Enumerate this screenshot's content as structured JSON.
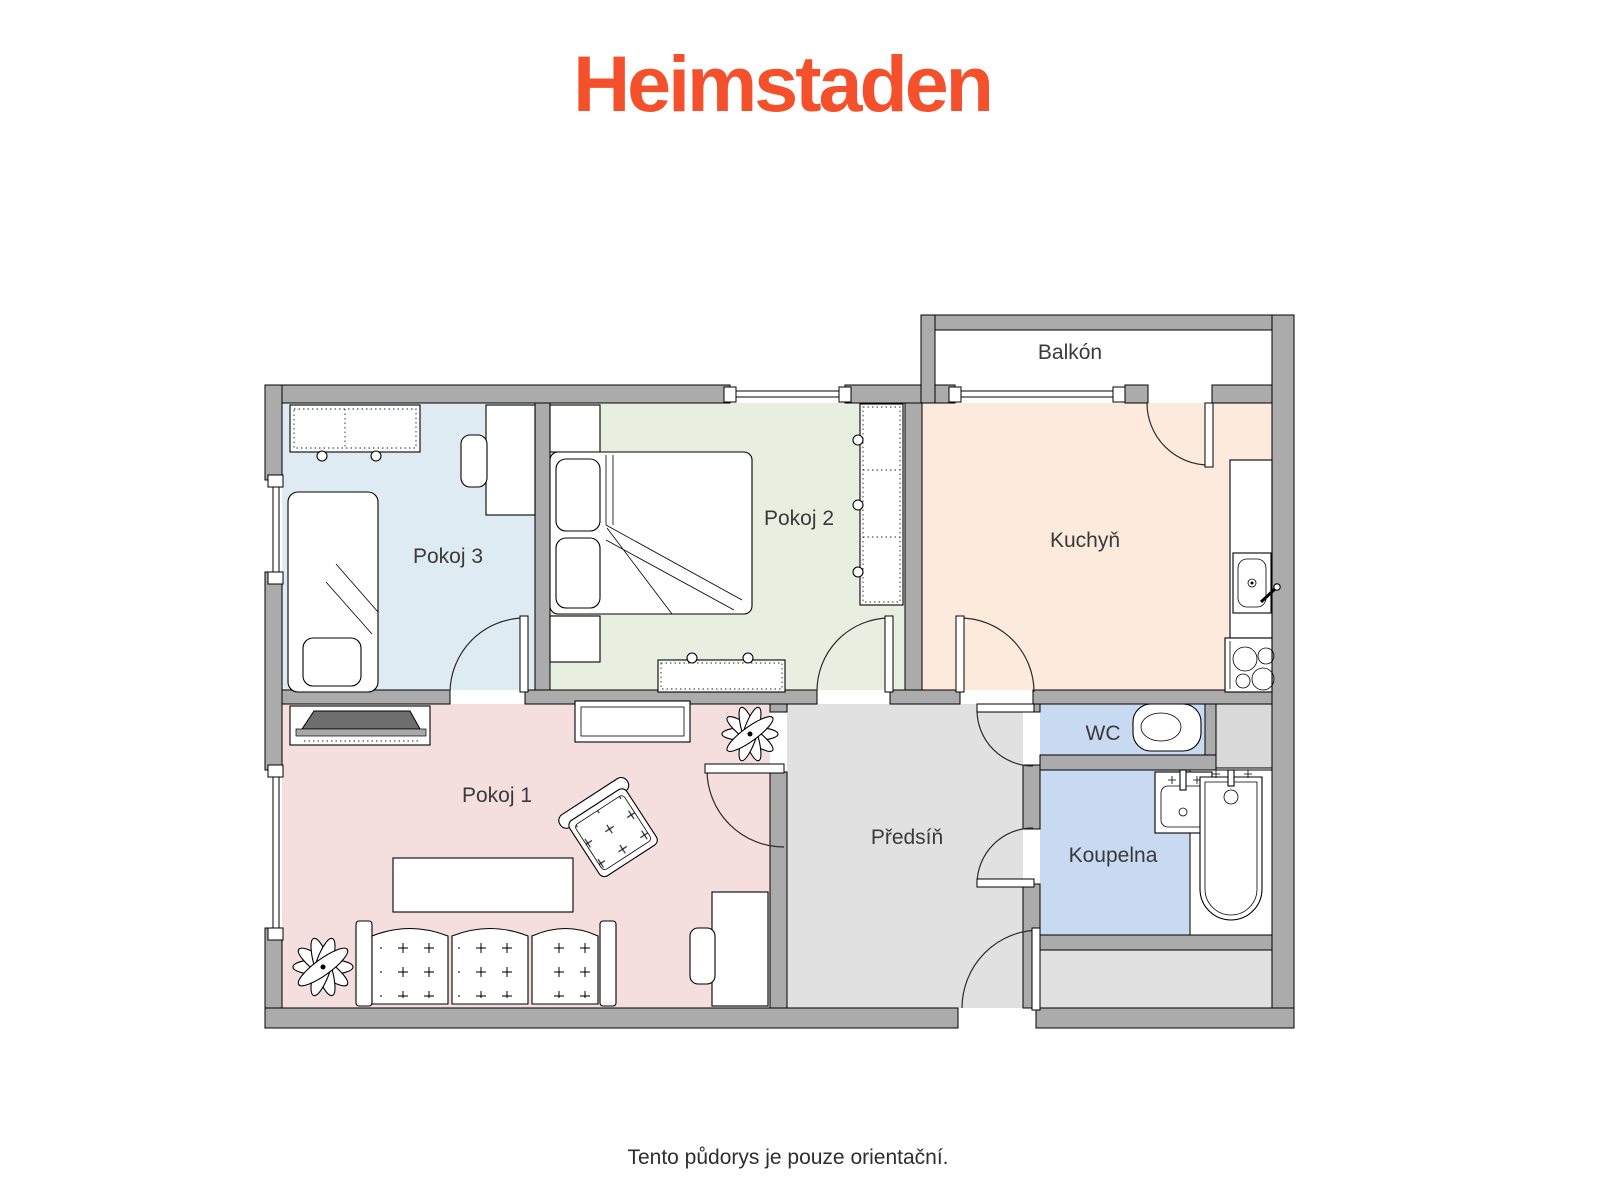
{
  "page": {
    "logo": "Heimstaden",
    "footer": "Tento půdorys je pouze orientační."
  },
  "colors": {
    "brand": "#F4502C",
    "wall": "#ABABAB",
    "outline": "#000000",
    "pokoj1": "#F5DFDE",
    "pokoj2": "#E9EFE0",
    "pokoj3": "#DEEBF3",
    "kuchyn": "#FCEADC",
    "wc": "#C8D9F2",
    "koupelna": "#C8D9F2",
    "predsin": "#E1E1E1",
    "corridor": "#E1E1E1",
    "shaft": "#D9D9D9",
    "balcony": "#FFFFFF",
    "label": "#3A3A3A"
  },
  "rooms": {
    "balkon": {
      "label": "Balkón"
    },
    "pokoj3": {
      "label": "Pokoj 3"
    },
    "pokoj2": {
      "label": "Pokoj 2"
    },
    "kuchyn": {
      "label": "Kuchyň"
    },
    "wc": {
      "label": "WC"
    },
    "koupelna": {
      "label": "Koupelna"
    },
    "predsin": {
      "label": "Předsíň"
    },
    "pokoj1": {
      "label": "Pokoj 1"
    }
  }
}
